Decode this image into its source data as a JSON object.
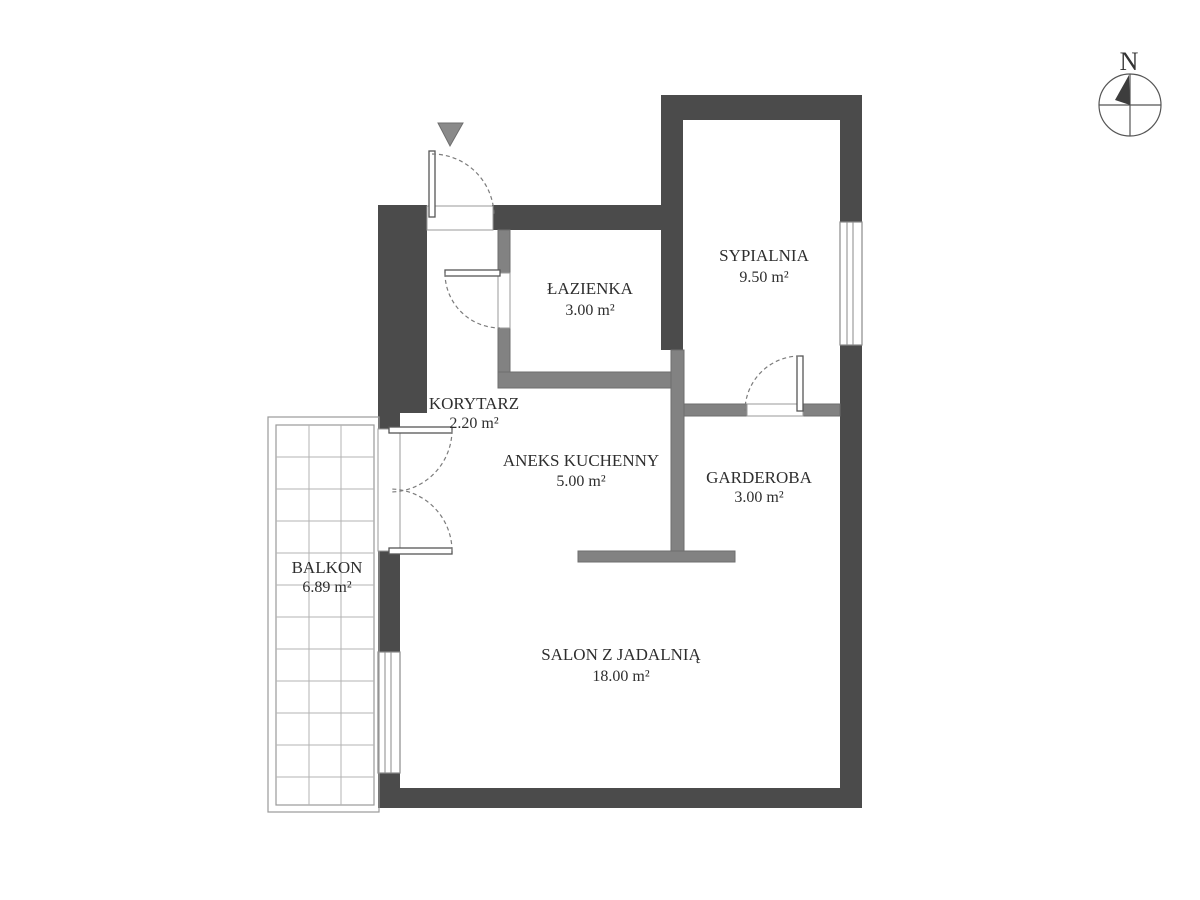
{
  "plan": {
    "compass": {
      "label": "N"
    },
    "rooms": [
      {
        "id": "sypialnia",
        "name": "SYPIALNIA",
        "area": "9.50 m²"
      },
      {
        "id": "lazienka",
        "name": "ŁAZIENKA",
        "area": "3.00 m²"
      },
      {
        "id": "korytarz",
        "name": "KORYTARZ",
        "area": "2.20 m²"
      },
      {
        "id": "aneks",
        "name": "ANEKS KUCHENNY",
        "area": "5.00 m²"
      },
      {
        "id": "garderoba",
        "name": "GARDEROBA",
        "area": "3.00 m²"
      },
      {
        "id": "salon",
        "name": "SALON Z JADALNIĄ",
        "area": "18.00 m²"
      },
      {
        "id": "balkon",
        "name": "BALKON",
        "area": "6.89 m²"
      }
    ],
    "colors": {
      "wall_dark": "#4b4b4b",
      "wall_light": "#828282",
      "entrance_marker": "#8a8a8a",
      "compass_needle": "#3d3d3d"
    }
  }
}
